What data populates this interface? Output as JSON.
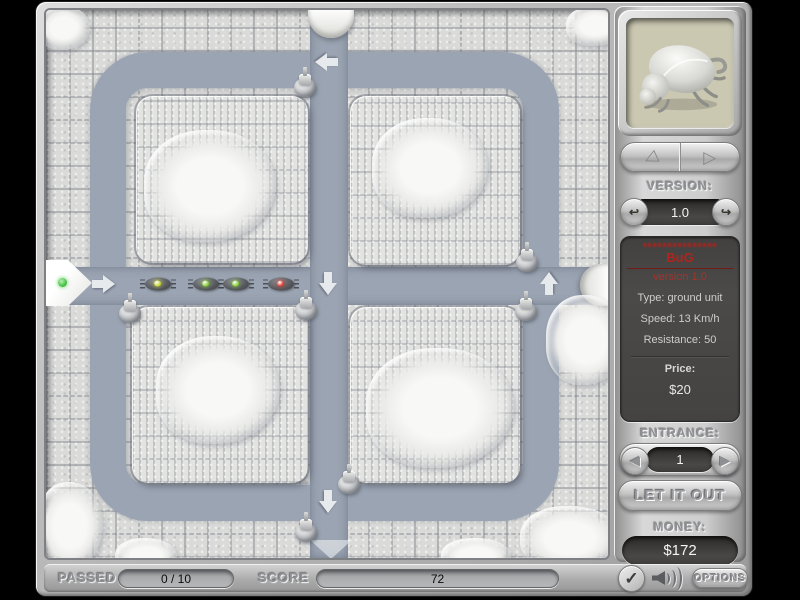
{
  "sidebar": {
    "version_label": "VERSION:",
    "version_value": "1.0",
    "unit": {
      "name": "BuG",
      "version_line": "version 1.0",
      "type_line": "Type: ground unit",
      "speed_line": "Speed: 13 Km/h",
      "resistance_line": "Resistance: 50",
      "price_label": "Price:",
      "price_value": "$20"
    },
    "entrance_label": "ENTRANCE:",
    "entrance_value": "1",
    "release_label": "LET IT OUT",
    "money_label": "MONEY:",
    "money_value": "$172"
  },
  "statusbar": {
    "passed_label": "PASSED",
    "passed_value": "0 / 10",
    "score_label": "SCORE",
    "score_value": "72",
    "options_label": "OPTIONS",
    "check_glyph": "✓"
  },
  "nav": {
    "prev_glyph": "◁",
    "next_glyph": "▷",
    "spin_prev_glyph": "↩",
    "spin_next_glyph": "↪",
    "tri_left": "◀",
    "tri_right": "▶"
  },
  "board": {
    "active_entrance": 1,
    "bugs": [
      {
        "x": 112,
        "y": 274,
        "eye": "#c6d42c"
      },
      {
        "x": 160,
        "y": 274,
        "eye": "#84cc30"
      },
      {
        "x": 190,
        "y": 274,
        "eye": "#84cc30"
      },
      {
        "x": 235,
        "y": 274,
        "eye": "#d8362a"
      }
    ],
    "turrets": [
      {
        "x": 259,
        "y": 72
      },
      {
        "x": 84,
        "y": 298
      },
      {
        "x": 260,
        "y": 295
      },
      {
        "x": 481,
        "y": 247
      },
      {
        "x": 480,
        "y": 296
      },
      {
        "x": 303,
        "y": 469
      },
      {
        "x": 260,
        "y": 517
      }
    ],
    "arrows": [
      {
        "x": 280,
        "y": 52,
        "dir": "left"
      },
      {
        "x": 58,
        "y": 274,
        "dir": "right"
      },
      {
        "x": 282,
        "y": 274,
        "dir": "down"
      },
      {
        "x": 503,
        "y": 273,
        "dir": "up"
      },
      {
        "x": 282,
        "y": 492,
        "dir": "down"
      }
    ],
    "snow_patches": [
      {
        "x": 164,
        "y": 176,
        "w": 132,
        "h": 112
      },
      {
        "x": 384,
        "y": 158,
        "w": 116,
        "h": 100
      },
      {
        "x": 172,
        "y": 380,
        "w": 124,
        "h": 108
      },
      {
        "x": 394,
        "y": 398,
        "w": 148,
        "h": 120
      },
      {
        "x": 540,
        "y": 330,
        "w": 80,
        "h": 90
      },
      {
        "x": 524,
        "y": 528,
        "w": 100,
        "h": 64
      },
      {
        "x": 24,
        "y": 516,
        "w": 66,
        "h": 88
      },
      {
        "x": 18,
        "y": 18,
        "w": 52,
        "h": 44
      },
      {
        "x": 550,
        "y": 16,
        "w": 60,
        "h": 40
      },
      {
        "x": 100,
        "y": 546,
        "w": 62,
        "h": 36
      },
      {
        "x": 430,
        "y": 546,
        "w": 70,
        "h": 36
      }
    ]
  },
  "colors": {
    "path": "#9ba4b2",
    "tile": "#dadad8",
    "accent_red": "#b0241c"
  }
}
